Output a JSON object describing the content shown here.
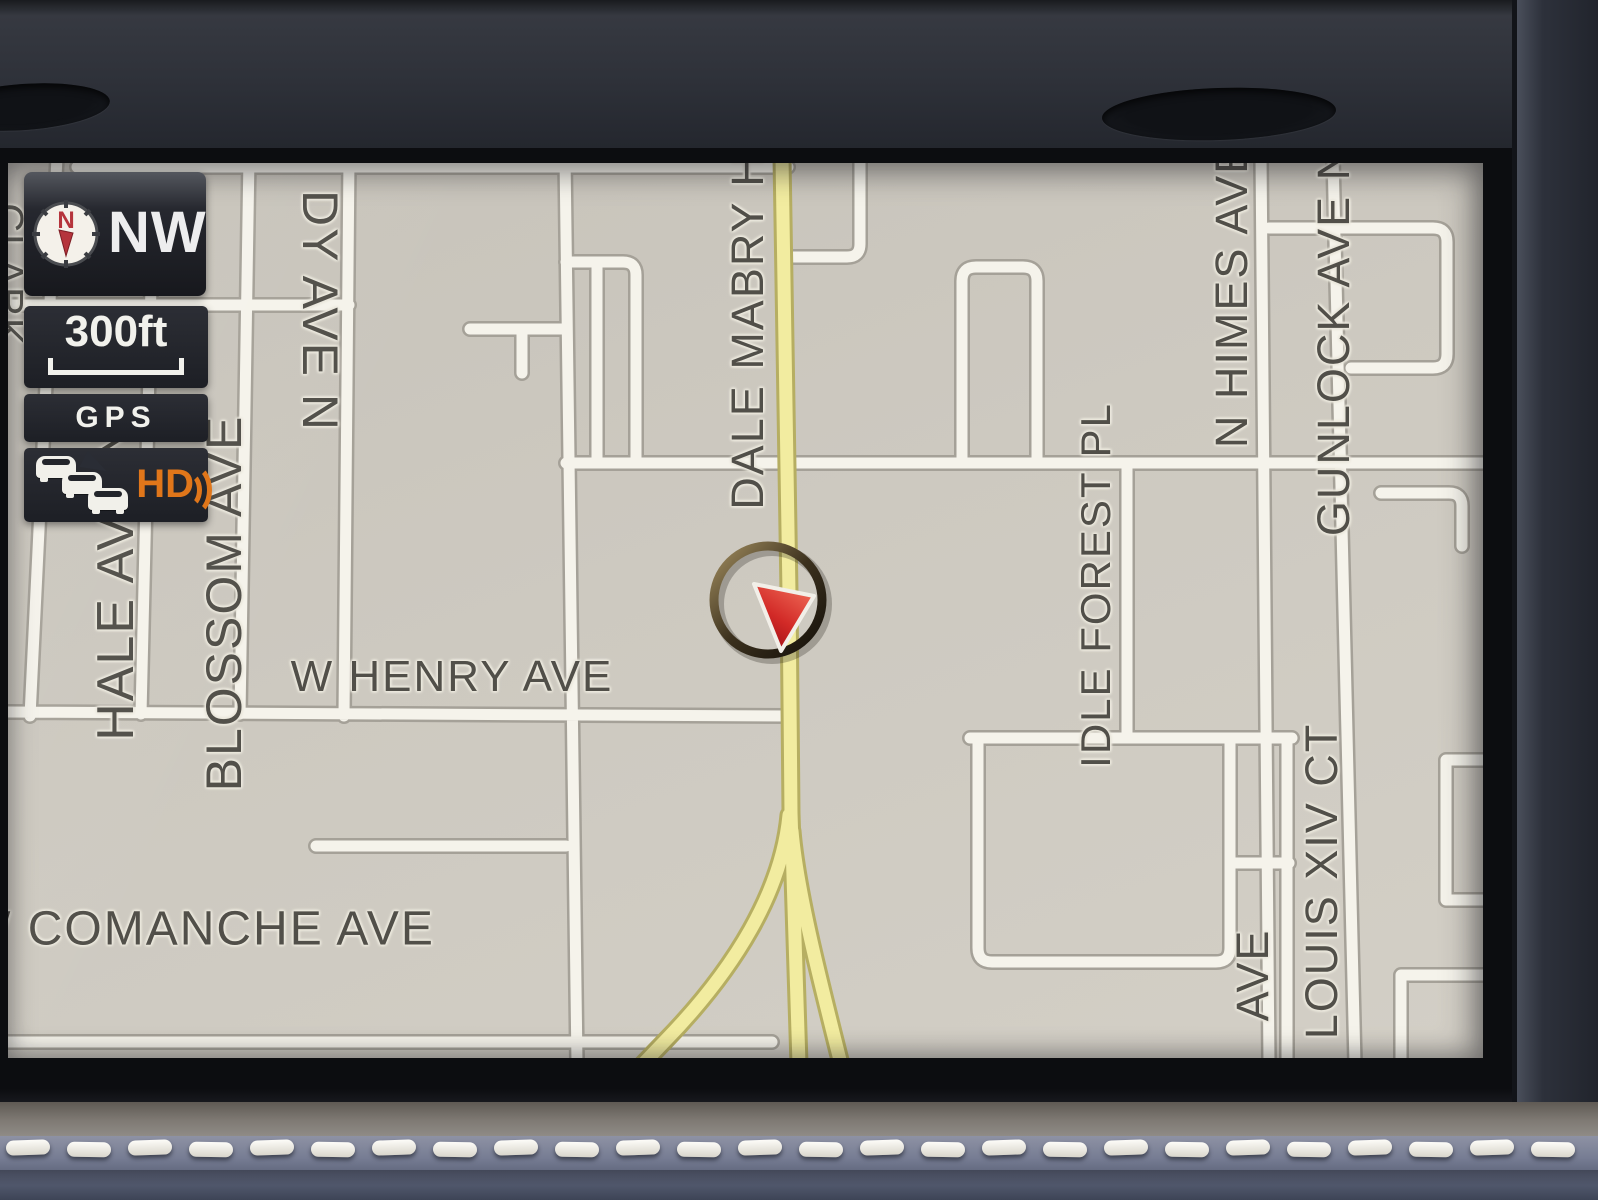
{
  "hud": {
    "compass": {
      "needle_label": "N",
      "heading": "NW"
    },
    "scale_label": "300ft",
    "gps_label": "GPS",
    "traffic": {
      "hd_label": "HD"
    }
  },
  "map": {
    "street_labels": {
      "clark_partial": "CLARK",
      "grady_partial": "DY AVE N",
      "dale_mabry_partial": "DALE MABRY H",
      "hale": "HALE AVE N",
      "blossom": "BLOSSOM AVE",
      "w_henry": "W HENRY AVE",
      "w_comanche": "W COMANCHE AVE",
      "idle_forest": "IDLE FOREST PL",
      "n_himes": "N HIMES AVE",
      "gunlock": "GUNLOCK AVE N",
      "louis_xiv": "LOUIS XIV CT",
      "ave_partial": "AVE"
    },
    "colors": {
      "map_background": "#cdc9c0",
      "road_fill": "#f5f3eb",
      "road_edge": "#a5a198",
      "highlighted_road_fill": "#f2eca0",
      "highlighted_road_edge": "#b6ae62",
      "label_text": "#514f49",
      "hud_badge_background": "#1d1f25",
      "hd_orange": "#e0761a",
      "marker_red": "#c1151f"
    }
  }
}
